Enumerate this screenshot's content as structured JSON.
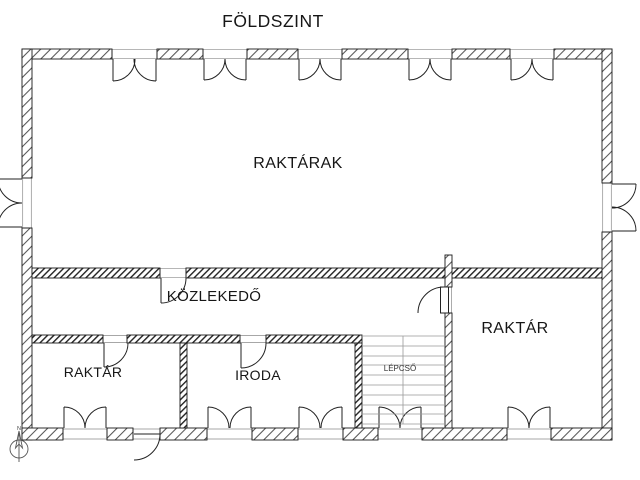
{
  "title": "FÖLDSZINT",
  "labels": {
    "title": "FÖLDSZINT",
    "rooms": {
      "raktarak": "RAKTÁRAK",
      "kozlekedo": "KÖZLEKEDŐ",
      "raktar_left": "RAKTÁR",
      "iroda": "IRODA",
      "raktar_right": "RAKTÁR",
      "lepcso": "LÉPCSŐ"
    },
    "north": "N"
  },
  "colors": {
    "background": "#ffffff",
    "line": "#1a1a1a",
    "hatch": "#555555",
    "stairs_line": "#999999"
  }
}
